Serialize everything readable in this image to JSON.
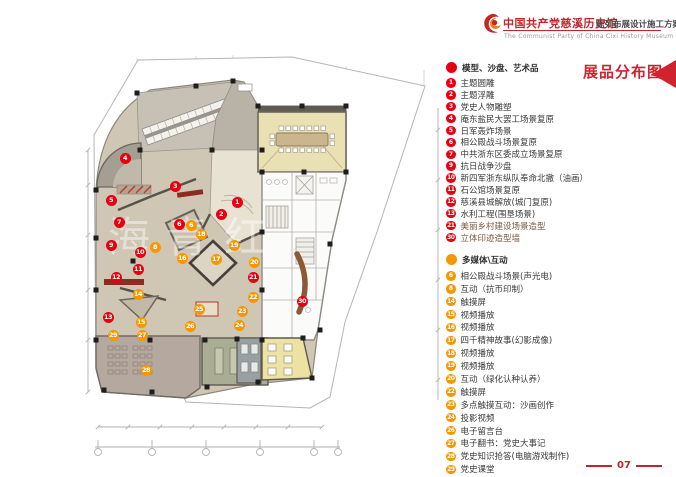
{
  "header": {
    "title": "中国共产党慈溪历史馆",
    "subtitle": "陈列布展设计施工方案",
    "english": "The Communist Party of China Cixi History Museum"
  },
  "page_title": "展品分布图",
  "page_number": "07",
  "watermark": "海青红",
  "colors": {
    "red": "#e60012",
    "orange": "#f39800",
    "accent": "#c3242a"
  },
  "legend": {
    "sections": [
      {
        "name": "models",
        "header": "模型、沙盘、艺术品",
        "color": "#e60012",
        "items": [
          {
            "num": "1",
            "label": "主题圆雕"
          },
          {
            "num": "2",
            "label": "主题浮雕"
          },
          {
            "num": "3",
            "label": "党史人物雕塑"
          },
          {
            "num": "4",
            "label": "庵东盐民大罢工场景复原"
          },
          {
            "num": "5",
            "label": "日军轰炸场景"
          },
          {
            "num": "6",
            "label": "相公殿战斗场景复原"
          },
          {
            "num": "7",
            "label": "中共浙东区委成立场景复原"
          },
          {
            "num": "9",
            "label": "抗日战争沙盘"
          },
          {
            "num": "10",
            "label": "新四军浙东纵队奉命北撤（油画）"
          },
          {
            "num": "11",
            "label": "石公馆场景复原"
          },
          {
            "num": "12",
            "label": "慈溪县城解放(城门复原)"
          },
          {
            "num": "13",
            "label": "水利工程(围垦场景)"
          },
          {
            "num": "21",
            "label": "美丽乡村建设场景造型",
            "tint": "#7a5a40"
          },
          {
            "num": "30",
            "label": "立体印迹造型墙",
            "tint": "#7a5a40"
          }
        ]
      },
      {
        "name": "multimedia",
        "header": "多媒体\\互动",
        "color": "#f39800",
        "items": [
          {
            "num": "6",
            "label": "相公殿战斗场景(声光电)"
          },
          {
            "num": "8",
            "label": "互动（抗币印制）"
          },
          {
            "num": "14",
            "label": "触摸屏"
          },
          {
            "num": "15",
            "label": "视频播放"
          },
          {
            "num": "16",
            "label": "视频播放"
          },
          {
            "num": "17",
            "label": "四千精神故事(幻影成像)"
          },
          {
            "num": "18",
            "label": "视频播放"
          },
          {
            "num": "19",
            "label": "视频播放"
          },
          {
            "num": "20",
            "label": "互动（绿化认种认养）"
          },
          {
            "num": "22",
            "label": "触摸屏"
          },
          {
            "num": "23",
            "label": "多点触摸互动：沙画创作"
          },
          {
            "num": "24",
            "label": "投影视频"
          },
          {
            "num": "26",
            "label": "电子留言台"
          },
          {
            "num": "27",
            "label": "电子翻书：党史大事记"
          },
          {
            "num": "28",
            "label": "党史知识抢答(电脑游戏制作)"
          },
          {
            "num": "29",
            "label": "党史课堂"
          }
        ]
      }
    ]
  },
  "plan": {
    "markers": [
      {
        "num": "1",
        "type": "red",
        "x": 237,
        "y": 202
      },
      {
        "num": "2",
        "type": "red",
        "x": 221,
        "y": 214
      },
      {
        "num": "3",
        "type": "red",
        "x": 175,
        "y": 186
      },
      {
        "num": "4",
        "type": "red",
        "x": 125,
        "y": 158
      },
      {
        "num": "5",
        "type": "red",
        "x": 111,
        "y": 200
      },
      {
        "num": "6",
        "type": "red",
        "x": 179,
        "y": 224
      },
      {
        "num": "7",
        "type": "red",
        "x": 119,
        "y": 222
      },
      {
        "num": "9",
        "type": "red",
        "x": 111,
        "y": 245
      },
      {
        "num": "10",
        "type": "red",
        "x": 140,
        "y": 252
      },
      {
        "num": "11",
        "type": "red",
        "x": 138,
        "y": 269
      },
      {
        "num": "12",
        "type": "red",
        "x": 116,
        "y": 277
      },
      {
        "num": "13",
        "type": "red",
        "x": 108,
        "y": 317
      },
      {
        "num": "21",
        "type": "red",
        "x": 253,
        "y": 277
      },
      {
        "num": "30",
        "type": "red",
        "x": 302,
        "y": 301
      },
      {
        "num": "6",
        "type": "orange",
        "x": 191,
        "y": 225
      },
      {
        "num": "8",
        "type": "orange",
        "x": 155,
        "y": 247
      },
      {
        "num": "14",
        "type": "orange",
        "x": 138,
        "y": 294
      },
      {
        "num": "15",
        "type": "orange",
        "x": 141,
        "y": 322
      },
      {
        "num": "16",
        "type": "orange",
        "x": 182,
        "y": 258
      },
      {
        "num": "17",
        "type": "orange",
        "x": 216,
        "y": 259
      },
      {
        "num": "18",
        "type": "orange",
        "x": 201,
        "y": 234
      },
      {
        "num": "19",
        "type": "orange",
        "x": 234,
        "y": 245
      },
      {
        "num": "20",
        "type": "orange",
        "x": 254,
        "y": 262
      },
      {
        "num": "22",
        "type": "orange",
        "x": 253,
        "y": 297
      },
      {
        "num": "23",
        "type": "orange",
        "x": 242,
        "y": 311
      },
      {
        "num": "24",
        "type": "orange",
        "x": 239,
        "y": 325
      },
      {
        "num": "25",
        "type": "orange",
        "x": 199,
        "y": 309
      },
      {
        "num": "26",
        "type": "orange",
        "x": 190,
        "y": 326
      },
      {
        "num": "27",
        "type": "orange",
        "x": 142,
        "y": 335
      },
      {
        "num": "28",
        "type": "orange",
        "x": 146,
        "y": 370
      },
      {
        "num": "29",
        "type": "orange",
        "x": 113,
        "y": 335
      }
    ]
  }
}
